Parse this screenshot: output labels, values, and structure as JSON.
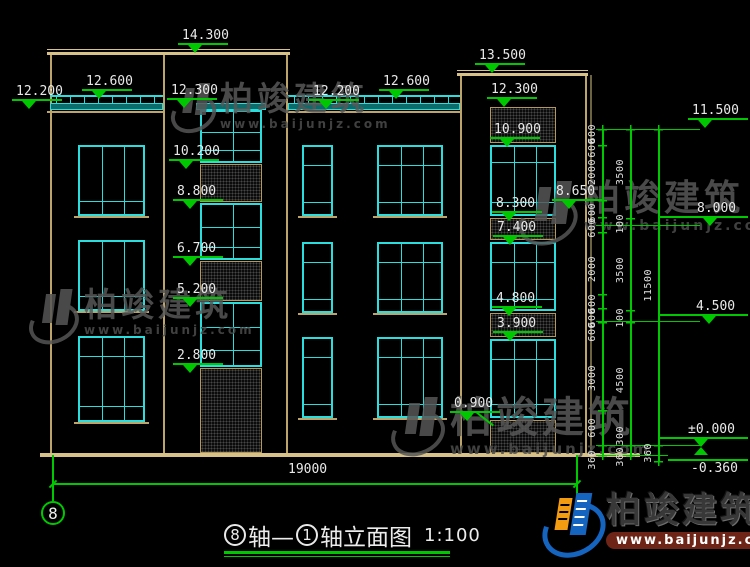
{
  "title": {
    "bubble_left": "8",
    "text_mid": "轴—",
    "bubble_right": "1",
    "text_right": "轴立面图",
    "scale": "1:100",
    "full": "⑧轴—①轴立面图 1:100"
  },
  "axis_bubble": {
    "label": "8"
  },
  "bottom_dim": {
    "label": "19000",
    "x1": 53,
    "x2": 577,
    "y": 483,
    "label_x": 288,
    "label_y": 462
  },
  "logo": {
    "name": "柏竣建筑",
    "url": "www.baijunjz.com"
  },
  "watermark": {
    "text": "柏竣建筑",
    "url": "www.baijunjz.com"
  },
  "colors": {
    "wall": "#bda56a",
    "wall_bright": "#d8c189",
    "cyan": "#2adede",
    "green": "#00c800",
    "text": "#e9e9e9",
    "hatch_border": "#b3995c"
  },
  "walls": {
    "verticals": [
      {
        "x": 50,
        "y1": 52,
        "y2": 453
      },
      {
        "x": 163,
        "y1": 52,
        "y2": 453
      },
      {
        "x": 286,
        "y1": 53,
        "y2": 453
      },
      {
        "x": 460,
        "y1": 75,
        "y2": 453
      },
      {
        "x": 585,
        "y1": 75,
        "y2": 453
      },
      {
        "x": 590,
        "y1": 75,
        "y2": 458,
        "dim": true
      }
    ],
    "horizontals": [
      {
        "x1": 47,
        "x2": 290,
        "y": 49,
        "h": 1,
        "bright": true
      },
      {
        "x1": 47,
        "x2": 290,
        "y": 52,
        "h": 3,
        "bright": true
      },
      {
        "x1": 457,
        "x2": 588,
        "y": 70,
        "h": 1,
        "bright": true
      },
      {
        "x1": 457,
        "x2": 588,
        "y": 73,
        "h": 3,
        "bright": true
      },
      {
        "x1": 40,
        "x2": 640,
        "y": 453,
        "h": 4,
        "bright": true
      },
      {
        "x1": 47,
        "x2": 164,
        "y": 111,
        "h": 2
      },
      {
        "x1": 286,
        "x2": 461,
        "y": 111,
        "h": 2
      },
      {
        "x1": 74,
        "x2": 149,
        "y": 216,
        "h": 2
      },
      {
        "x1": 74,
        "x2": 149,
        "y": 311,
        "h": 2
      },
      {
        "x1": 74,
        "x2": 149,
        "y": 422,
        "h": 2
      },
      {
        "x1": 298,
        "x2": 337,
        "y": 216,
        "h": 2
      },
      {
        "x1": 298,
        "x2": 337,
        "y": 313,
        "h": 2
      },
      {
        "x1": 298,
        "x2": 337,
        "y": 418,
        "h": 2
      },
      {
        "x1": 373,
        "x2": 447,
        "y": 216,
        "h": 2
      },
      {
        "x1": 373,
        "x2": 447,
        "y": 313,
        "h": 2
      },
      {
        "x1": 373,
        "x2": 447,
        "y": 418,
        "h": 2
      }
    ]
  },
  "railings": [
    {
      "x1": 50,
      "x2": 163,
      "band_only": false
    },
    {
      "x1": 288,
      "x2": 460,
      "band_only": false
    },
    {
      "x1": 196,
      "x2": 266,
      "band_only": true
    }
  ],
  "windows": [
    {
      "x": 78,
      "y": 145,
      "w": 67,
      "h": 71,
      "cols": [
        22,
        44
      ],
      "rows": [
        54
      ]
    },
    {
      "x": 78,
      "y": 240,
      "w": 67,
      "h": 71,
      "cols": [
        22,
        44
      ],
      "rows": [
        54
      ]
    },
    {
      "x": 78,
      "y": 336,
      "w": 67,
      "h": 86,
      "cols": [
        22,
        44
      ],
      "rows": [
        18,
        68
      ]
    },
    {
      "x": 302,
      "y": 145,
      "w": 31,
      "h": 71,
      "cols": [],
      "rows": [
        18,
        55
      ]
    },
    {
      "x": 302,
      "y": 242,
      "w": 31,
      "h": 71,
      "cols": [],
      "rows": [
        18,
        55
      ]
    },
    {
      "x": 302,
      "y": 337,
      "w": 31,
      "h": 81,
      "cols": [],
      "rows": [
        18,
        65
      ]
    },
    {
      "x": 377,
      "y": 145,
      "w": 66,
      "h": 71,
      "cols": [
        22,
        44
      ],
      "rows": [
        18,
        55
      ]
    },
    {
      "x": 377,
      "y": 242,
      "w": 66,
      "h": 71,
      "cols": [
        22,
        44
      ],
      "rows": [
        18,
        55
      ]
    },
    {
      "x": 377,
      "y": 337,
      "w": 66,
      "h": 81,
      "cols": [
        22,
        44
      ],
      "rows": [
        18,
        65
      ]
    },
    {
      "x": 200,
      "y": 110,
      "w": 62,
      "h": 53,
      "cols": [
        31
      ],
      "rows": [
        20,
        38
      ]
    },
    {
      "x": 200,
      "y": 203,
      "w": 62,
      "h": 57,
      "cols": [
        31
      ],
      "rows": [
        22,
        42
      ]
    },
    {
      "x": 200,
      "y": 302,
      "w": 62,
      "h": 65,
      "cols": [
        31
      ],
      "rows": [
        23,
        46
      ]
    },
    {
      "x": 490,
      "y": 145,
      "w": 66,
      "h": 71,
      "cols": [
        22,
        44
      ],
      "rows": [
        15,
        55
      ]
    },
    {
      "x": 490,
      "y": 242,
      "w": 66,
      "h": 69,
      "cols": [
        22,
        44
      ],
      "rows": [
        18,
        55
      ]
    },
    {
      "x": 490,
      "y": 339,
      "w": 66,
      "h": 79,
      "cols": [
        22,
        44
      ],
      "rows": [
        18,
        63
      ]
    }
  ],
  "hatches": [
    {
      "x": 200,
      "y": 164,
      "w": 62,
      "h": 38
    },
    {
      "x": 200,
      "y": 261,
      "w": 62,
      "h": 40
    },
    {
      "x": 200,
      "y": 368,
      "w": 62,
      "h": 85
    },
    {
      "x": 490,
      "y": 107,
      "w": 66,
      "h": 36
    },
    {
      "x": 490,
      "y": 218,
      "w": 66,
      "h": 22
    },
    {
      "x": 490,
      "y": 313,
      "w": 66,
      "h": 24
    },
    {
      "x": 490,
      "y": 420,
      "w": 66,
      "h": 33
    }
  ],
  "markers": [
    {
      "label": "12.200",
      "tx": 16,
      "ty": 85
    },
    {
      "label": "12.600",
      "tx": 86,
      "ty": 75
    },
    {
      "label": "14.300",
      "tx": 182,
      "ty": 29
    },
    {
      "label": "12.300",
      "tx": 171,
      "ty": 84
    },
    {
      "label": "10.200",
      "tx": 173,
      "ty": 145
    },
    {
      "label": "8.800",
      "tx": 177,
      "ty": 185
    },
    {
      "label": "6.700",
      "tx": 177,
      "ty": 242
    },
    {
      "label": "5.200",
      "tx": 177,
      "ty": 283
    },
    {
      "label": "2.800",
      "tx": 177,
      "ty": 349
    },
    {
      "label": "12.200",
      "tx": 313,
      "ty": 85
    },
    {
      "label": "12.600",
      "tx": 383,
      "ty": 75
    },
    {
      "label": "13.500",
      "tx": 479,
      "ty": 49
    },
    {
      "label": "12.300",
      "tx": 491,
      "ty": 83
    },
    {
      "label": "10.900",
      "tx": 494,
      "ty": 123
    },
    {
      "label": "8.300",
      "tx": 496,
      "ty": 197
    },
    {
      "label": "7.400",
      "tx": 497,
      "ty": 221
    },
    {
      "label": "4.800",
      "tx": 496,
      "ty": 292
    },
    {
      "label": "3.900",
      "tx": 497,
      "ty": 317
    },
    {
      "label": "0.900",
      "tx": 454,
      "ty": 397
    },
    {
      "label": "8.650",
      "tx": 556,
      "ty": 185
    }
  ],
  "right_markers": [
    {
      "label": "11.500",
      "tx": 692,
      "ty": 104,
      "lx": 688,
      "lw": 60,
      "style": "std"
    },
    {
      "label": "8.000",
      "tx": 697,
      "ty": 202,
      "lx": 660,
      "lw": 88,
      "style": "std"
    },
    {
      "label": "4.500",
      "tx": 696,
      "ty": 300,
      "lx": 660,
      "lw": 88,
      "style": "std"
    },
    {
      "label": "±0.000",
      "tx": 688,
      "ty": 423,
      "lx": 658,
      "lw": 90,
      "style": "pm"
    },
    {
      "label": "-0.360",
      "tx": 691,
      "ty": 462,
      "lx": 668,
      "lw": 80,
      "style": "below"
    }
  ],
  "chains": {
    "verticals": [
      {
        "x": 602,
        "y1": 129,
        "y2": 455
      },
      {
        "x": 630,
        "y1": 129,
        "y2": 455
      },
      {
        "x": 658,
        "y1": 129,
        "y2": 461
      }
    ],
    "connectors": [
      {
        "x1": 596,
        "x2": 700,
        "y": 129
      },
      {
        "x1": 596,
        "x2": 700,
        "y": 225
      },
      {
        "x1": 596,
        "x2": 700,
        "y": 321
      },
      {
        "x1": 596,
        "x2": 700,
        "y": 445
      },
      {
        "x1": 596,
        "x2": 668,
        "y": 455
      }
    ],
    "labels": [
      {
        "t": "600",
        "x": 602,
        "y": 124
      },
      {
        "t": "600",
        "x": 602,
        "y": 138
      },
      {
        "t": "2000",
        "x": 602,
        "y": 159
      },
      {
        "t": "600",
        "x": 602,
        "y": 203
      },
      {
        "t": "600",
        "x": 602,
        "y": 218
      },
      {
        "t": "2000",
        "x": 602,
        "y": 256
      },
      {
        "t": "600",
        "x": 602,
        "y": 294
      },
      {
        "t": "600",
        "x": 602,
        "y": 308
      },
      {
        "t": "600",
        "x": 602,
        "y": 322
      },
      {
        "t": "3000",
        "x": 602,
        "y": 365
      },
      {
        "t": "600",
        "x": 602,
        "y": 418
      },
      {
        "t": "360",
        "x": 602,
        "y": 450
      },
      {
        "t": "3500",
        "x": 630,
        "y": 159
      },
      {
        "t": "100",
        "x": 630,
        "y": 214
      },
      {
        "t": "3500",
        "x": 630,
        "y": 257
      },
      {
        "t": "100",
        "x": 630,
        "y": 308
      },
      {
        "t": "4500",
        "x": 630,
        "y": 367
      },
      {
        "t": "300",
        "x": 630,
        "y": 426
      },
      {
        "t": "360",
        "x": 630,
        "y": 447
      },
      {
        "t": "11500",
        "x": 658,
        "y": 269
      },
      {
        "t": "360",
        "x": 658,
        "y": 443
      }
    ],
    "ticks": [
      {
        "x": 602,
        "y": 129
      },
      {
        "x": 602,
        "y": 145
      },
      {
        "x": 602,
        "y": 200
      },
      {
        "x": 602,
        "y": 217
      },
      {
        "x": 602,
        "y": 232
      },
      {
        "x": 602,
        "y": 294
      },
      {
        "x": 602,
        "y": 308
      },
      {
        "x": 602,
        "y": 322
      },
      {
        "x": 602,
        "y": 410
      },
      {
        "x": 602,
        "y": 445
      },
      {
        "x": 602,
        "y": 455
      },
      {
        "x": 630,
        "y": 129
      },
      {
        "x": 630,
        "y": 218
      },
      {
        "x": 630,
        "y": 310
      },
      {
        "x": 630,
        "y": 322
      },
      {
        "x": 630,
        "y": 445
      },
      {
        "x": 630,
        "y": 455
      },
      {
        "x": 658,
        "y": 129
      },
      {
        "x": 658,
        "y": 445
      },
      {
        "x": 658,
        "y": 461
      }
    ]
  },
  "green_lines": [
    {
      "x": 52,
      "y": 455,
      "w": 2,
      "h": 46,
      "vert": true
    },
    {
      "x": 576,
      "y": 455,
      "w": 2,
      "h": 43,
      "vert": true
    },
    {
      "x": 476,
      "y": 411,
      "w": 22,
      "h": 2,
      "rot": 38
    }
  ],
  "watermarks": [
    {
      "x": 170,
      "y": 82,
      "icon": 46,
      "f": 33,
      "uf": 12
    },
    {
      "x": 28,
      "y": 288,
      "icon": 52,
      "f": 33,
      "uf": 12
    },
    {
      "x": 518,
      "y": 180,
      "icon": 62,
      "f": 36,
      "uf": 14
    },
    {
      "x": 390,
      "y": 396,
      "icon": 56,
      "f": 42,
      "uf": 15
    }
  ]
}
